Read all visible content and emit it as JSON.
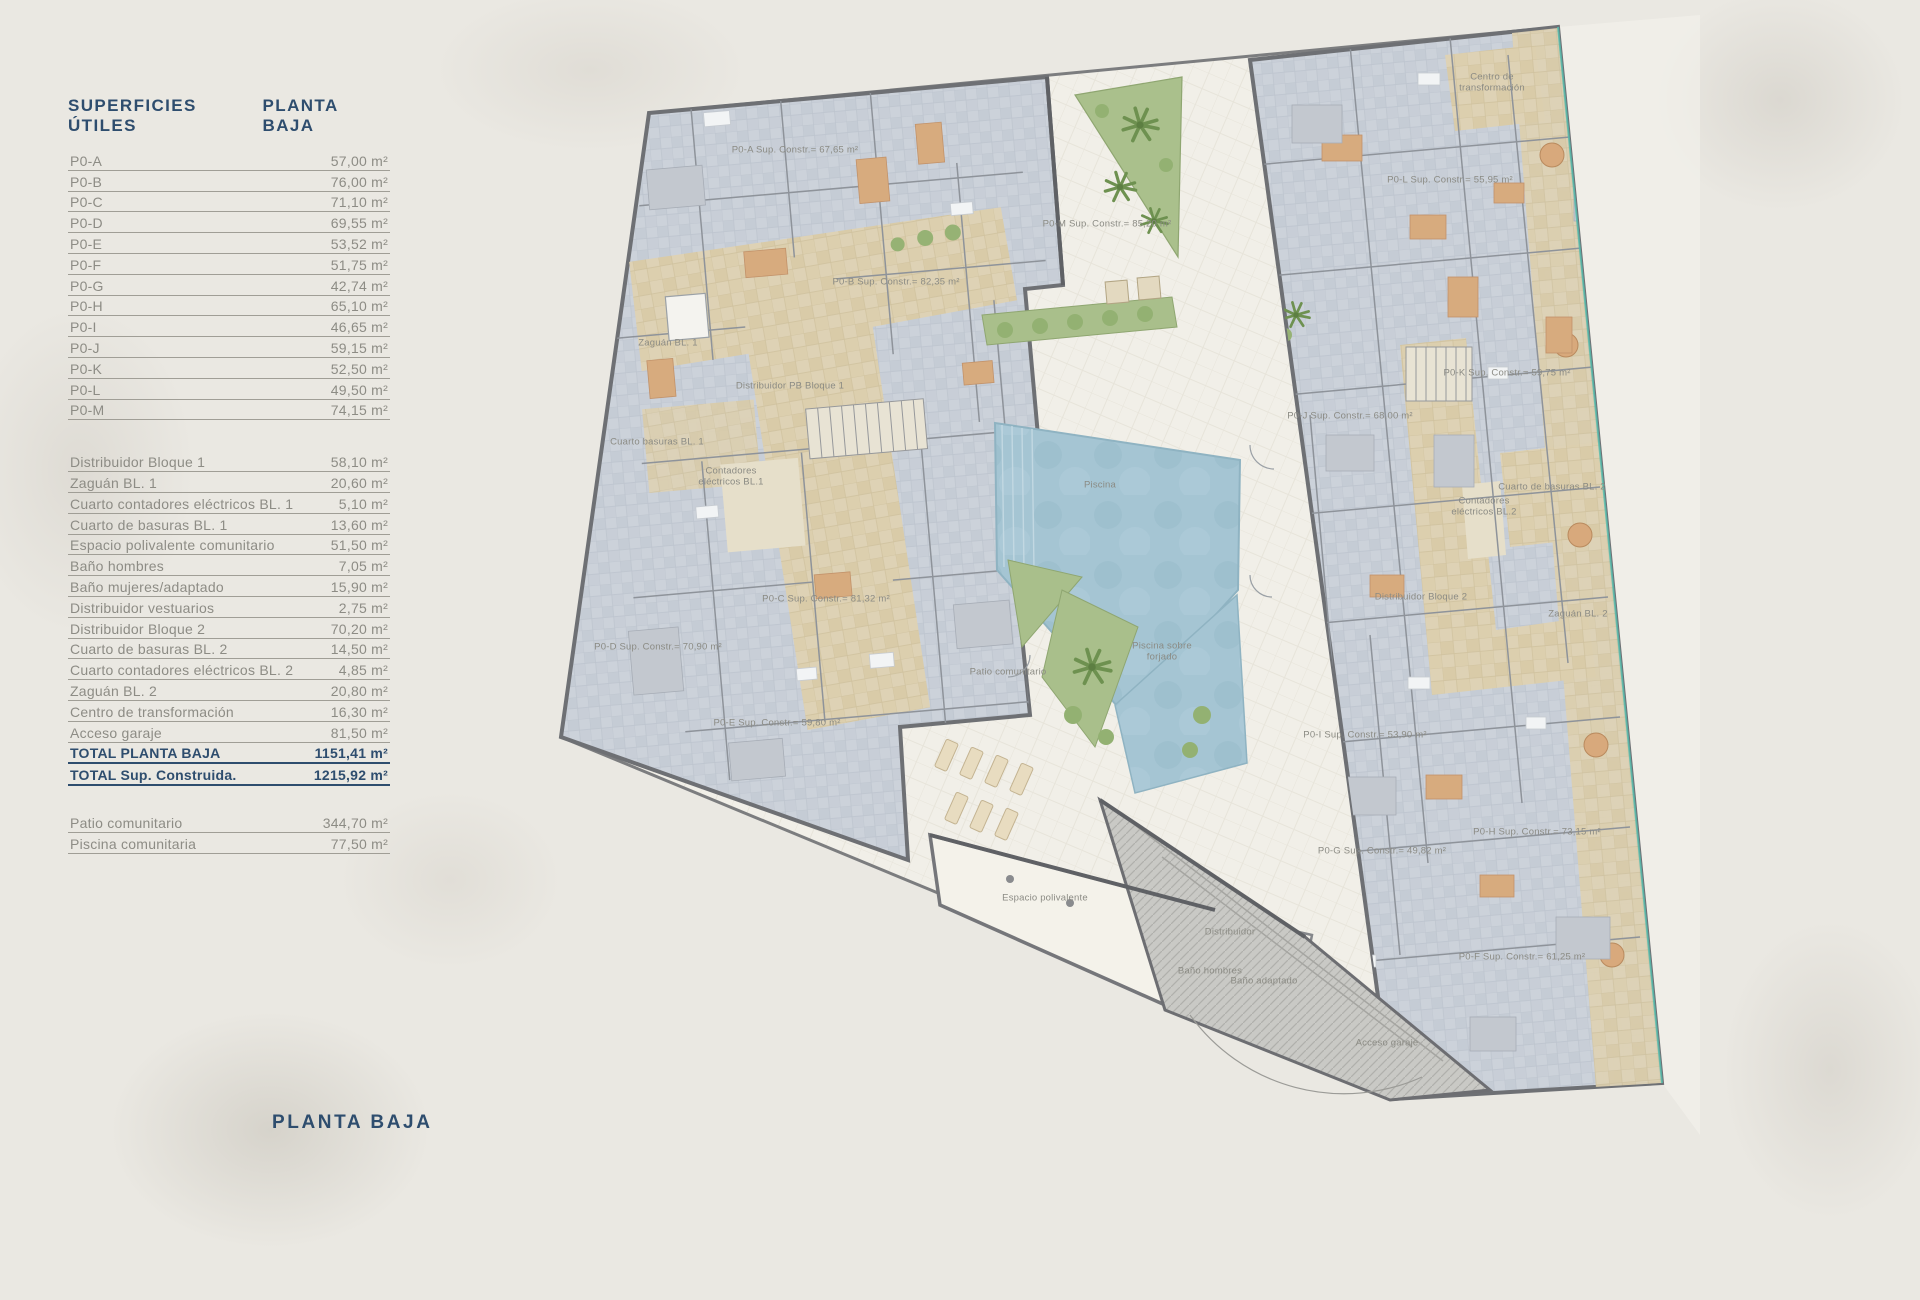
{
  "page": {
    "bottom_title": "PLANTA BAJA"
  },
  "table": {
    "title": "SUPERFICIES ÚTILES",
    "floor": "PLANTA BAJA",
    "apartments": [
      {
        "label": "P0-A",
        "value": "57,00 m²"
      },
      {
        "label": "P0-B",
        "value": "76,00 m²"
      },
      {
        "label": "P0-C",
        "value": "71,10 m²"
      },
      {
        "label": "P0-D",
        "value": "69,55 m²"
      },
      {
        "label": "P0-E",
        "value": "53,52 m²"
      },
      {
        "label": "P0-F",
        "value": "51,75 m²"
      },
      {
        "label": "P0-G",
        "value": "42,74 m²"
      },
      {
        "label": "P0-H",
        "value": "65,10 m²"
      },
      {
        "label": "P0-I",
        "value": "46,65 m²"
      },
      {
        "label": "P0-J",
        "value": "59,15 m²"
      },
      {
        "label": "P0-K",
        "value": "52,50 m²"
      },
      {
        "label": "P0-L",
        "value": "49,50 m²"
      },
      {
        "label": "P0-M",
        "value": "74,15 m²"
      }
    ],
    "common": [
      {
        "label": "Distribuidor Bloque 1",
        "value": "58,10 m²"
      },
      {
        "label": "Zaguán BL. 1",
        "value": "20,60 m²"
      },
      {
        "label": "Cuarto contadores eléctricos BL. 1",
        "value": "5,10 m²"
      },
      {
        "label": "Cuarto de basuras BL. 1",
        "value": "13,60 m²"
      },
      {
        "label": "Espacio polivalente comunitario",
        "value": "51,50 m²"
      },
      {
        "label": "Baño hombres",
        "value": "7,05 m²"
      },
      {
        "label": "Baño mujeres/adaptado",
        "value": "15,90 m²"
      },
      {
        "label": "Distribuidor vestuarios",
        "value": "2,75 m²"
      },
      {
        "label": "Distribuidor Bloque 2",
        "value": "70,20 m²"
      },
      {
        "label": "Cuarto de basuras BL. 2",
        "value": "14,50 m²"
      },
      {
        "label": "Cuarto contadores eléctricos BL. 2",
        "value": "4,85 m²"
      },
      {
        "label": "Zaguán BL. 2",
        "value": "20,80 m²"
      },
      {
        "label": "Centro de transformación",
        "value": "16,30 m²"
      },
      {
        "label": "Acceso garaje",
        "value": "81,50 m²"
      }
    ],
    "totals": [
      {
        "label": "TOTAL PLANTA BAJA",
        "value": "1151,41 m²"
      },
      {
        "label": "TOTAL Sup. Construida.",
        "value": "1215,92 m²"
      }
    ],
    "outdoor": [
      {
        "label": "Patio comunitario",
        "value": "344,70 m²"
      },
      {
        "label": "Piscina comunitaria",
        "value": "77,50 m²"
      }
    ]
  },
  "plan": {
    "labels": [
      {
        "text": "P0-A Sup. Constr.= 67,65 m²",
        "x": 245,
        "y": 135
      },
      {
        "text": "P0-B Sup. Constr.= 82,35 m²",
        "x": 346,
        "y": 267
      },
      {
        "text": "Zaguán BL. 1",
        "x": 118,
        "y": 328
      },
      {
        "text": "Distribuidor PB Bloque 1",
        "x": 240,
        "y": 371
      },
      {
        "text": "Cuarto basuras BL. 1",
        "x": 107,
        "y": 427
      },
      {
        "text": "Contadores eléctricos BL.1",
        "x": 181,
        "y": 462,
        "w": 66
      },
      {
        "text": "P0-C Sup. Constr.= 81,32 m²",
        "x": 276,
        "y": 584
      },
      {
        "text": "P0-D Sup. Constr.= 70,90 m²",
        "x": 108,
        "y": 632
      },
      {
        "text": "P0-E Sup. Constr.= 59,80 m²",
        "x": 227,
        "y": 708
      },
      {
        "text": "Patio comunitario",
        "x": 458,
        "y": 657
      },
      {
        "text": "Piscina",
        "x": 550,
        "y": 470
      },
      {
        "text": "Piscina sobre forjado",
        "x": 612,
        "y": 637,
        "w": 78
      },
      {
        "text": "Espacio polivalente",
        "x": 495,
        "y": 883
      },
      {
        "text": "Distribuidor",
        "x": 680,
        "y": 917
      },
      {
        "text": "Baño hombres",
        "x": 660,
        "y": 956
      },
      {
        "text": "Baño adaptado",
        "x": 714,
        "y": 966
      },
      {
        "text": "Acceso garaje",
        "x": 837,
        "y": 1028
      },
      {
        "text": "P0-F Sup. Constr.= 61,25 m²",
        "x": 972,
        "y": 942
      },
      {
        "text": "P0-G Sup. Constr.= 49,82 m²",
        "x": 832,
        "y": 836
      },
      {
        "text": "P0-H Sup. Constr.= 73,15 m²",
        "x": 987,
        "y": 817
      },
      {
        "text": "P0-I Sup. Constr.= 53,90 m²",
        "x": 815,
        "y": 720
      },
      {
        "text": "P0-J Sup. Constr.= 68,00 m²",
        "x": 800,
        "y": 401
      },
      {
        "text": "P0-K Sup. Constr.= 59,75 m²",
        "x": 957,
        "y": 358
      },
      {
        "text": "Cuarto de basuras BL. 2",
        "x": 1002,
        "y": 472
      },
      {
        "text": "Contadores eléctricos BL.2",
        "x": 934,
        "y": 492,
        "w": 70
      },
      {
        "text": "Distribuidor Bloque 2",
        "x": 871,
        "y": 582
      },
      {
        "text": "Zaguán BL. 2",
        "x": 1028,
        "y": 599
      },
      {
        "text": "Centro de transformación",
        "x": 942,
        "y": 68,
        "w": 92
      },
      {
        "text": "P0-L Sup. Constr.= 55,95 m²",
        "x": 900,
        "y": 165
      },
      {
        "text": "P0-M Sup. Constr.= 85,20 m²",
        "x": 557,
        "y": 209
      }
    ]
  }
}
